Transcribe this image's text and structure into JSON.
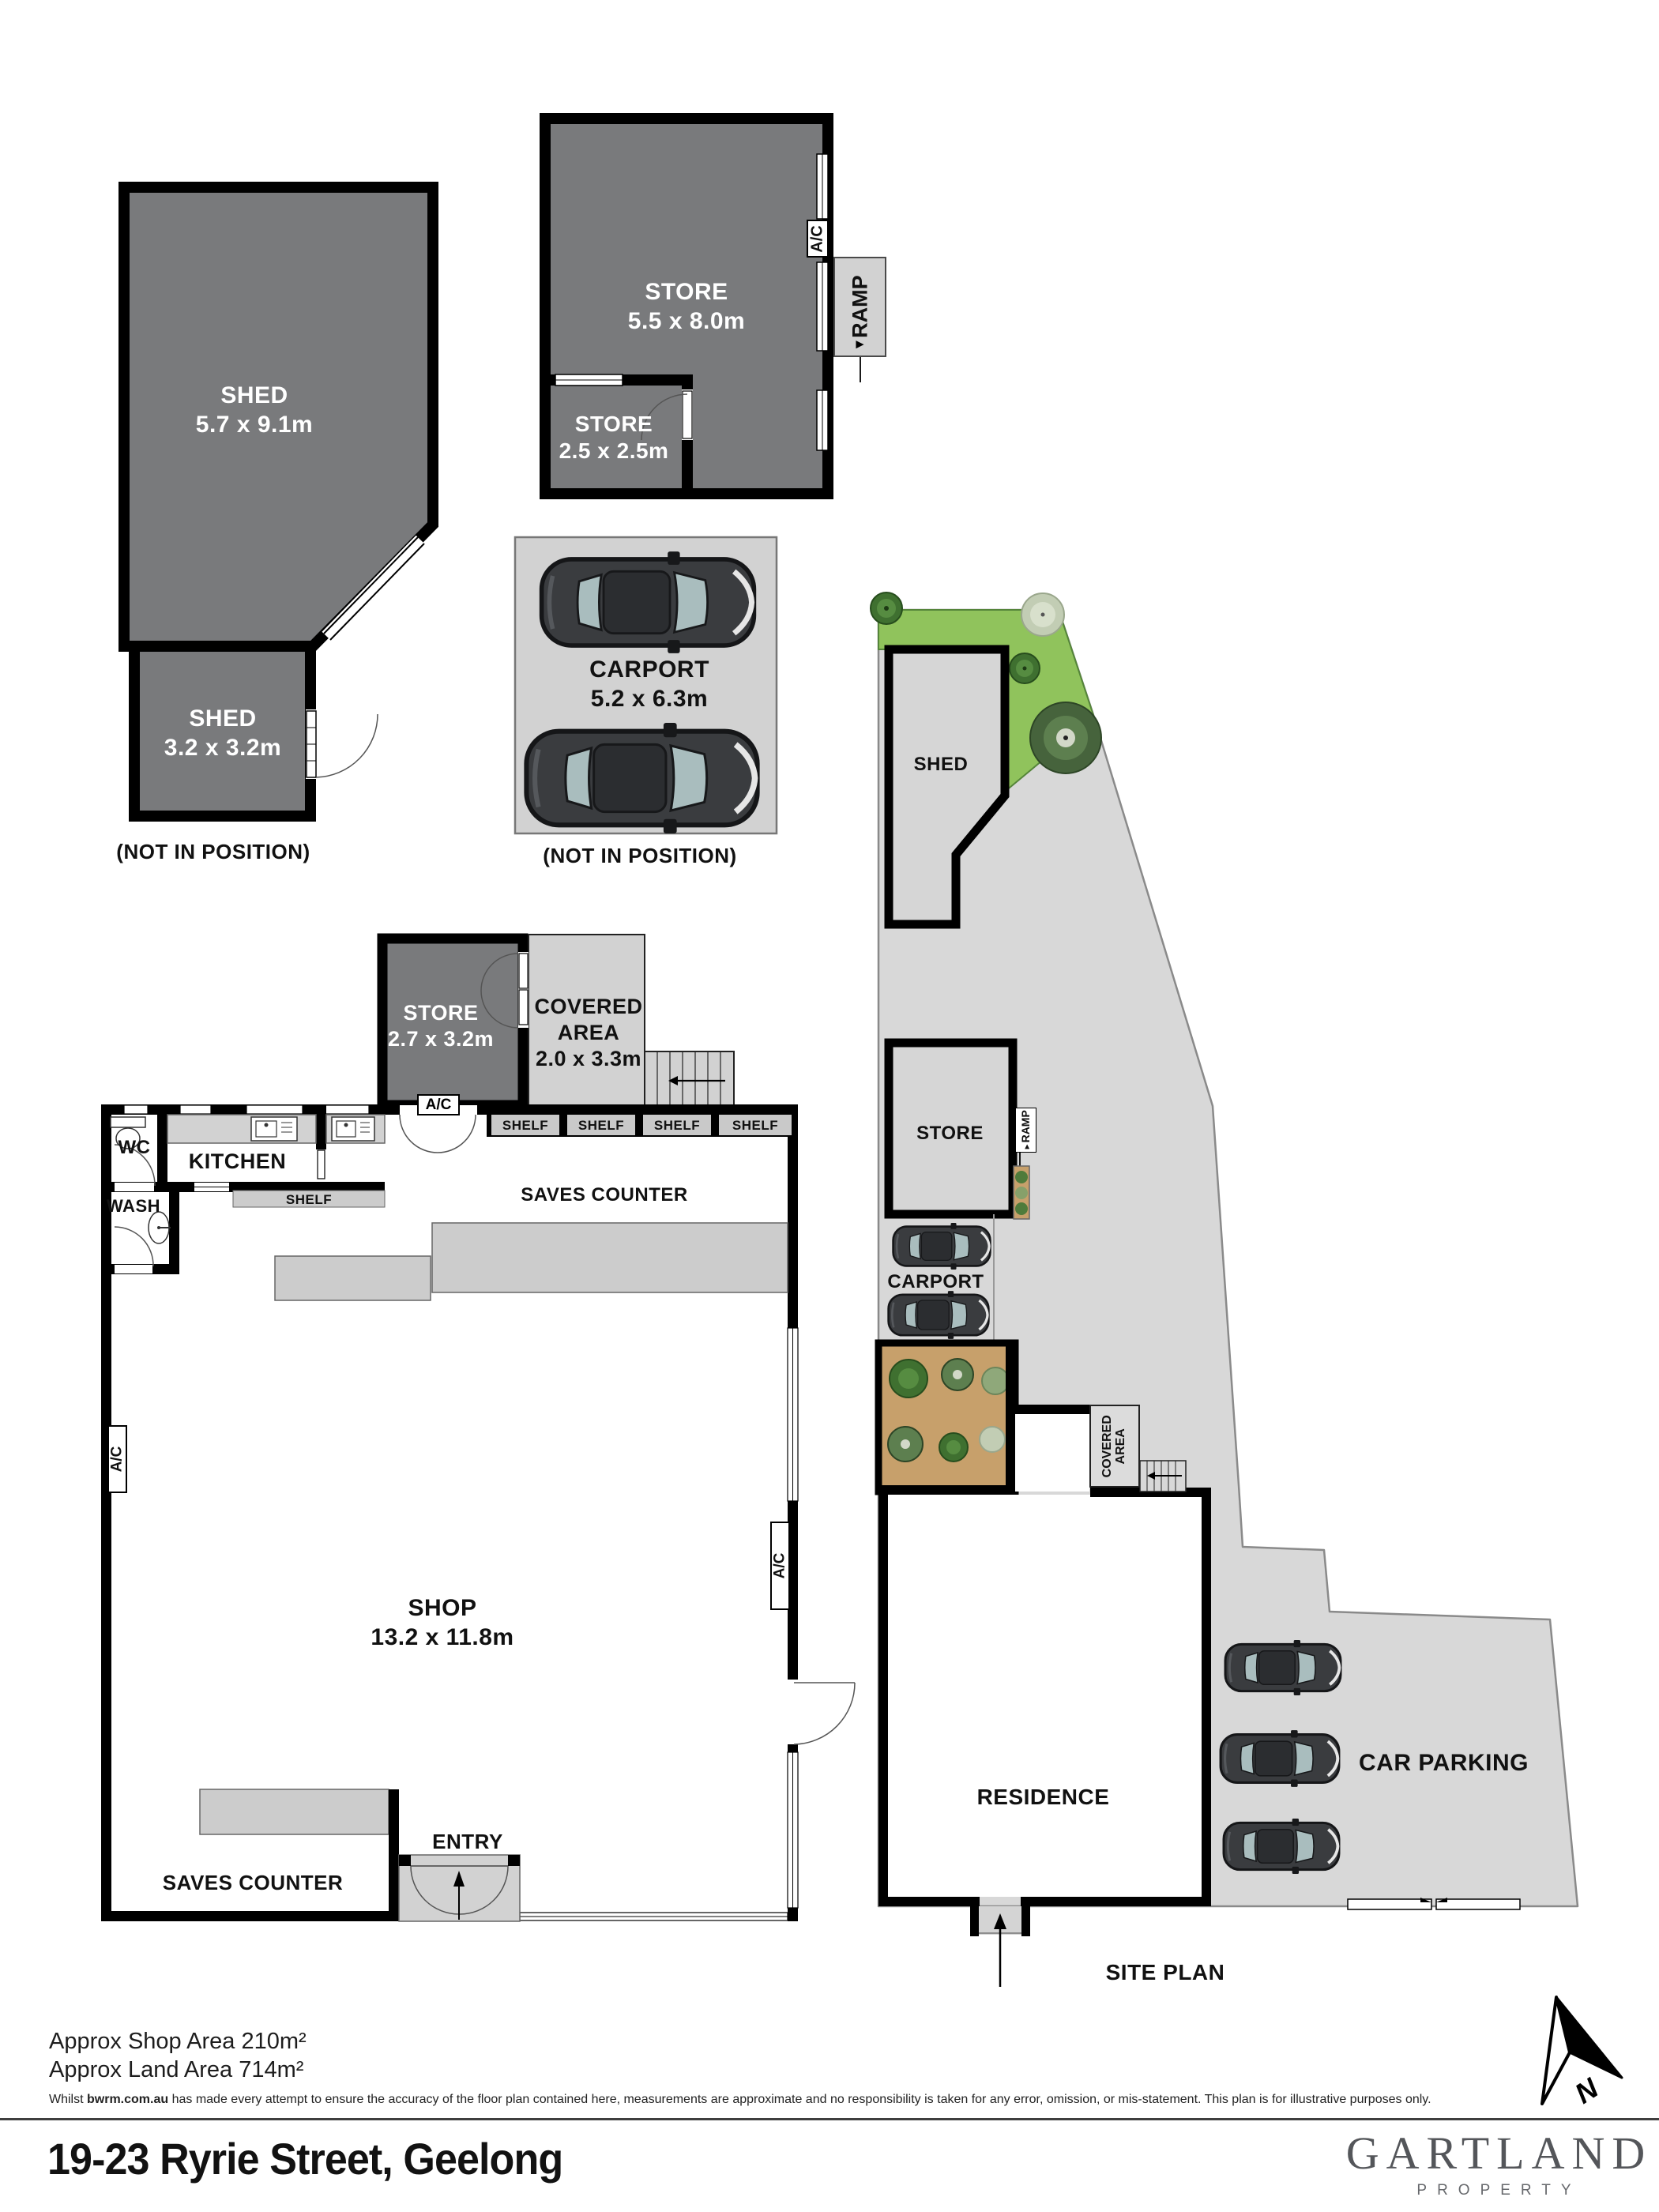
{
  "title": "19-23 Ryrie Street, Geelong",
  "brand": {
    "name": "GARTLAND",
    "tagline": "PROPERTY"
  },
  "compass": {
    "north": "N"
  },
  "icons": {
    "arrow_right": "►"
  },
  "colors": {
    "room_dark": "#797a7c",
    "paving": "#d8d8d8",
    "grass": "#90c35c",
    "garden_bed": "#c7a06b",
    "counter": "#cccccc",
    "wall": "#000000"
  },
  "footer": {
    "shop_area": "Approx Shop Area 210m²",
    "land_area": "Approx Land Area 714m²",
    "disclaimer_lead": "Whilst ",
    "disclaimer_brand": "bwrm.com.au",
    "disclaimer_rest": " has made every attempt to ensure the accuracy of the floor plan contained here, measurements are approximate and no responsibility is taken for any error, omission, or mis-statement. This plan is for illustrative purposes only."
  },
  "detached": {
    "shed_large": {
      "name": "SHED",
      "dims": "5.7 x 9.1m"
    },
    "shed_small": {
      "name": "SHED",
      "dims": "3.2 x 3.2m"
    },
    "note_left": "(NOT IN POSITION)",
    "store_large": {
      "name": "STORE",
      "dims": "5.5 x 8.0m"
    },
    "store_small": {
      "name": "STORE",
      "dims": "2.5 x 2.5m"
    },
    "ac": "A/C",
    "ramp": "RAMP",
    "carport": {
      "name": "CARPORT",
      "dims": "5.2 x 6.3m"
    },
    "note_middle": "(NOT IN POSITION)"
  },
  "floorplan": {
    "wc": "WC",
    "kitchen": "KITCHEN",
    "wash": "WASH",
    "shelf": "SHELF",
    "shelves": [
      "SHELF",
      "SHELF",
      "SHELF",
      "SHELF"
    ],
    "saves_counter_top": "SAVES COUNTER",
    "store": {
      "name": "STORE",
      "dims": "2.7 x 3.2m"
    },
    "covered": {
      "line1": "COVERED",
      "line2": "AREA",
      "dims": "2.0 x 3.3m"
    },
    "ac_store": "A/C",
    "ac_left": "A/C",
    "ac_right": "A/C",
    "shop": {
      "name": "SHOP",
      "dims": "13.2 x 11.8m"
    },
    "entry": "ENTRY",
    "saves_counter_bottom": "SAVES COUNTER"
  },
  "siteplan": {
    "shed": "SHED",
    "store": "STORE",
    "ramp": "RAMP",
    "carport": "CARPORT",
    "covered_line1": "COVERED",
    "covered_line2": "AREA",
    "residence": "RESIDENCE",
    "car_parking": "CAR PARKING",
    "caption": "SITE PLAN"
  }
}
